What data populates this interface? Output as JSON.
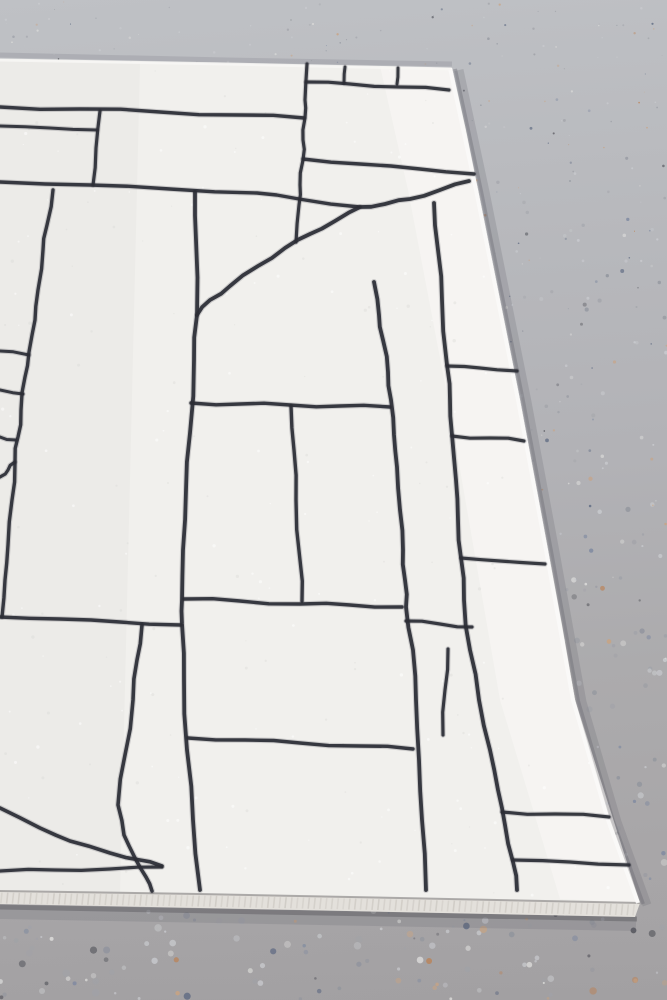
{
  "meta": {
    "kind": "photograph",
    "subject": "white rug with black hand-drawn geometric grid pattern lying on a speckled terrazzo concrete floor, viewed at an angle showing its top-right corner, right edge and bottom bound edge",
    "canvas": {
      "width": 667,
      "height": 1000
    }
  },
  "floor": {
    "base_top_color": "#bfc1c5",
    "base_mid_color": "#b2b2b6",
    "base_bottom_color": "#a5a3a5",
    "speckle_seed": 42,
    "speckle_count": 1250,
    "speckle_palette": [
      {
        "color": "#c9cbcf",
        "weight": 26
      },
      {
        "color": "#a0a2a8",
        "weight": 22
      },
      {
        "color": "#90949d",
        "weight": 12
      },
      {
        "color": "#7d88a0",
        "weight": 8
      },
      {
        "color": "#5e6a82",
        "weight": 5
      },
      {
        "color": "#c9a382",
        "weight": 8
      },
      {
        "color": "#bd7f4f",
        "weight": 4
      },
      {
        "color": "#54555c",
        "weight": 5
      },
      {
        "color": "#dddddb",
        "weight": 10
      }
    ]
  },
  "rug": {
    "pile_color": "#f1f0ed",
    "pile_shade_left": "#e7e6e4",
    "pile_highlight_right": "#f9f8f6",
    "line_color": "#2b2d35",
    "selvedge_color": "#e3e0db",
    "selvedge_rib_color": "#cfcbc5",
    "selvedge_gap_color": "#9c9a98",
    "shadow_color": "#64646c",
    "texture_seed": 7,
    "texture_dot_count": 320,
    "outline": [
      [
        0,
        59
      ],
      [
        150,
        62
      ],
      [
        300,
        65
      ],
      [
        452,
        68
      ],
      [
        466,
        130
      ],
      [
        478,
        190
      ],
      [
        500,
        300
      ],
      [
        520,
        400
      ],
      [
        535,
        480
      ],
      [
        548,
        550
      ],
      [
        562,
        625
      ],
      [
        575,
        700
      ],
      [
        592,
        762
      ],
      [
        610,
        820
      ],
      [
        640,
        903
      ],
      [
        400,
        898
      ],
      [
        200,
        894
      ],
      [
        0,
        891
      ]
    ],
    "selvedge": [
      [
        0,
        891
      ],
      [
        200,
        894
      ],
      [
        400,
        898
      ],
      [
        640,
        903
      ],
      [
        635,
        917
      ],
      [
        300,
        910
      ],
      [
        0,
        904
      ]
    ],
    "right_edge": [
      [
        452,
        68
      ],
      [
        478,
        190
      ],
      [
        520,
        400
      ],
      [
        548,
        550
      ],
      [
        575,
        700
      ],
      [
        610,
        820
      ],
      [
        640,
        903
      ]
    ],
    "pattern_lines": [
      {
        "name": "h1-top-left",
        "width": 3.4,
        "pts": [
          [
            0,
            107
          ],
          [
            80,
            109
          ],
          [
            160,
            112
          ],
          [
            240,
            115
          ],
          [
            304,
            118
          ]
        ]
      },
      {
        "name": "h2-short-left",
        "width": 3.0,
        "pts": [
          [
            0,
            126
          ],
          [
            50,
            128
          ],
          [
            97,
            130
          ]
        ]
      },
      {
        "name": "v1-connector",
        "width": 3.2,
        "pts": [
          [
            100,
            111
          ],
          [
            96,
            148
          ],
          [
            93,
            185
          ]
        ]
      },
      {
        "name": "h3-long",
        "width": 3.4,
        "pts": [
          [
            0,
            182
          ],
          [
            90,
            185
          ],
          [
            170,
            189
          ],
          [
            257,
            193
          ],
          [
            299,
            199
          ],
          [
            360,
            207
          ]
        ]
      },
      {
        "name": "v3-corner-rail",
        "width": 3.2,
        "pts": [
          [
            307,
            64
          ],
          [
            305,
            100
          ],
          [
            305,
            118
          ],
          [
            303,
            140
          ],
          [
            303,
            160
          ],
          [
            300,
            185
          ],
          [
            299,
            205
          ],
          [
            296,
            242
          ]
        ]
      },
      {
        "name": "h-corner-band",
        "width": 3.2,
        "pts": [
          [
            306,
            82
          ],
          [
            350,
            84
          ],
          [
            400,
            87
          ],
          [
            449,
            90
          ]
        ]
      },
      {
        "name": "tick-1",
        "width": 3.0,
        "pts": [
          [
            345,
            67
          ],
          [
            344,
            83
          ]
        ]
      },
      {
        "name": "tick-2",
        "width": 3.0,
        "pts": [
          [
            398,
            68
          ],
          [
            397,
            84
          ]
        ]
      },
      {
        "name": "h-long-upper",
        "width": 3.4,
        "pts": [
          [
            303,
            159
          ],
          [
            360,
            164
          ],
          [
            420,
            169
          ],
          [
            474,
            174
          ]
        ]
      },
      {
        "name": "diagonal-sweep",
        "width": 3.8,
        "pts": [
          [
            469,
            181
          ],
          [
            440,
            190
          ],
          [
            410,
            199
          ],
          [
            385,
            204
          ],
          [
            360,
            207
          ],
          [
            335,
            221
          ],
          [
            310,
            234
          ],
          [
            285,
            248
          ],
          [
            258,
            266
          ],
          [
            230,
            286
          ],
          [
            210,
            300
          ],
          [
            197,
            315
          ]
        ]
      },
      {
        "name": "v4-center-rail",
        "width": 3.8,
        "pts": [
          [
            195,
            192
          ],
          [
            196,
            240
          ],
          [
            197,
            315
          ],
          [
            194,
            360
          ],
          [
            190,
            433
          ],
          [
            186,
            490
          ],
          [
            183,
            550
          ],
          [
            182,
            600
          ],
          [
            182,
            624
          ],
          [
            184,
            680
          ],
          [
            187,
            750
          ],
          [
            193,
            820
          ],
          [
            200,
            890
          ]
        ]
      },
      {
        "name": "h4-mid",
        "width": 3.4,
        "pts": [
          [
            191,
            403
          ],
          [
            240,
            404
          ],
          [
            290,
            405
          ],
          [
            340,
            406
          ],
          [
            390,
            407
          ]
        ]
      },
      {
        "name": "v5-hanging",
        "width": 3.4,
        "pts": [
          [
            291,
            406
          ],
          [
            294,
            450
          ],
          [
            296,
            500
          ],
          [
            300,
            560
          ],
          [
            302,
            601
          ]
        ]
      },
      {
        "name": "h6-right",
        "width": 3.4,
        "pts": [
          [
            184,
            599
          ],
          [
            240,
            601
          ],
          [
            300,
            604
          ],
          [
            350,
            605
          ],
          [
            402,
            607
          ]
        ]
      },
      {
        "name": "h6-left",
        "width": 3.4,
        "pts": [
          [
            0,
            617
          ],
          [
            60,
            619
          ],
          [
            120,
            622
          ],
          [
            181,
            625
          ]
        ]
      },
      {
        "name": "v6-lower-left",
        "width": 3.6,
        "pts": [
          [
            142,
            625
          ],
          [
            137,
            660
          ],
          [
            133,
            700
          ],
          [
            125,
            755
          ],
          [
            118,
            805
          ],
          [
            124,
            835
          ],
          [
            135,
            858
          ],
          [
            146,
            877
          ],
          [
            152,
            891
          ]
        ]
      },
      {
        "name": "sweep-lower-1",
        "width": 3.6,
        "pts": [
          [
            0,
            808
          ],
          [
            40,
            828
          ],
          [
            70,
            841
          ],
          [
            110,
            853
          ],
          [
            140,
            860
          ],
          [
            162,
            866
          ]
        ]
      },
      {
        "name": "sweep-lower-2",
        "width": 3.2,
        "pts": [
          [
            0,
            871
          ],
          [
            55,
            870
          ],
          [
            110,
            869
          ],
          [
            162,
            867
          ]
        ]
      },
      {
        "name": "h7-bottom",
        "width": 3.4,
        "pts": [
          [
            188,
            738
          ],
          [
            245,
            740
          ],
          [
            300,
            743
          ],
          [
            360,
            746
          ],
          [
            413,
            749
          ]
        ]
      },
      {
        "name": "rail-left",
        "width": 3.8,
        "pts": [
          [
            374,
            282
          ],
          [
            379,
            315
          ],
          [
            383,
            340
          ],
          [
            388,
            372
          ],
          [
            391,
            400
          ],
          [
            394,
            435
          ],
          [
            397,
            467
          ],
          [
            400,
            510
          ],
          [
            403,
            550
          ],
          [
            405,
            580
          ],
          [
            406,
            607
          ],
          [
            413,
            650
          ],
          [
            416,
            700
          ],
          [
            419,
            760
          ],
          [
            422,
            820
          ],
          [
            426,
            890
          ]
        ]
      },
      {
        "name": "rail-right",
        "width": 3.8,
        "pts": [
          [
            434,
            203
          ],
          [
            438,
            250
          ],
          [
            442,
            300
          ],
          [
            447,
            365
          ],
          [
            450,
            400
          ],
          [
            452,
            435
          ],
          [
            456,
            480
          ],
          [
            458,
            520
          ],
          [
            461,
            558
          ],
          [
            464,
            600
          ],
          [
            470,
            650
          ],
          [
            479,
            700
          ],
          [
            490,
            750
          ],
          [
            498,
            790
          ],
          [
            505,
            825
          ],
          [
            513,
            862
          ],
          [
            517,
            890
          ]
        ]
      },
      {
        "name": "rung-1",
        "width": 3.2,
        "pts": [
          [
            447,
            366
          ],
          [
            480,
            368
          ],
          [
            517,
            371
          ]
        ]
      },
      {
        "name": "rung-2",
        "width": 3.2,
        "pts": [
          [
            452,
            436
          ],
          [
            490,
            438
          ],
          [
            524,
            441
          ]
        ]
      },
      {
        "name": "rung-3",
        "width": 3.2,
        "pts": [
          [
            461,
            558
          ],
          [
            500,
            561
          ],
          [
            545,
            564
          ]
        ]
      },
      {
        "name": "h5-between-rails",
        "width": 3.2,
        "pts": [
          [
            406,
            621
          ],
          [
            440,
            624
          ],
          [
            472,
            627
          ]
        ]
      },
      {
        "name": "v7-short",
        "width": 3.2,
        "pts": [
          [
            448,
            649
          ],
          [
            445,
            690
          ],
          [
            443,
            735
          ]
        ]
      },
      {
        "name": "rung-4",
        "width": 3.2,
        "pts": [
          [
            502,
            812
          ],
          [
            555,
            814
          ],
          [
            609,
            817
          ]
        ]
      },
      {
        "name": "rung-5",
        "width": 3.2,
        "pts": [
          [
            513,
            860
          ],
          [
            570,
            862
          ],
          [
            629,
            865
          ]
        ]
      },
      {
        "name": "ladder-rung-a",
        "width": 3.0,
        "pts": [
          [
            0,
            351
          ],
          [
            29,
            355
          ]
        ]
      },
      {
        "name": "ladder-rung-b",
        "width": 3.0,
        "pts": [
          [
            0,
            390
          ],
          [
            23,
            394
          ]
        ]
      },
      {
        "name": "ladder-rung-c",
        "width": 3.0,
        "pts": [
          [
            0,
            437
          ],
          [
            16,
            440
          ]
        ]
      },
      {
        "name": "v-left-rail",
        "width": 3.4,
        "pts": [
          [
            53,
            190
          ],
          [
            47,
            225
          ],
          [
            43,
            250
          ],
          [
            38,
            290
          ],
          [
            35,
            320
          ],
          [
            29,
            352
          ],
          [
            25,
            377
          ],
          [
            21,
            410
          ],
          [
            18,
            437
          ],
          [
            15,
            462
          ],
          [
            12,
            500
          ],
          [
            8,
            545
          ],
          [
            5,
            580
          ],
          [
            2,
            617
          ]
        ]
      },
      {
        "name": "fork-left",
        "width": 3.2,
        "pts": [
          [
            15,
            462
          ],
          [
            8,
            470
          ],
          [
            0,
            477
          ]
        ]
      }
    ]
  }
}
